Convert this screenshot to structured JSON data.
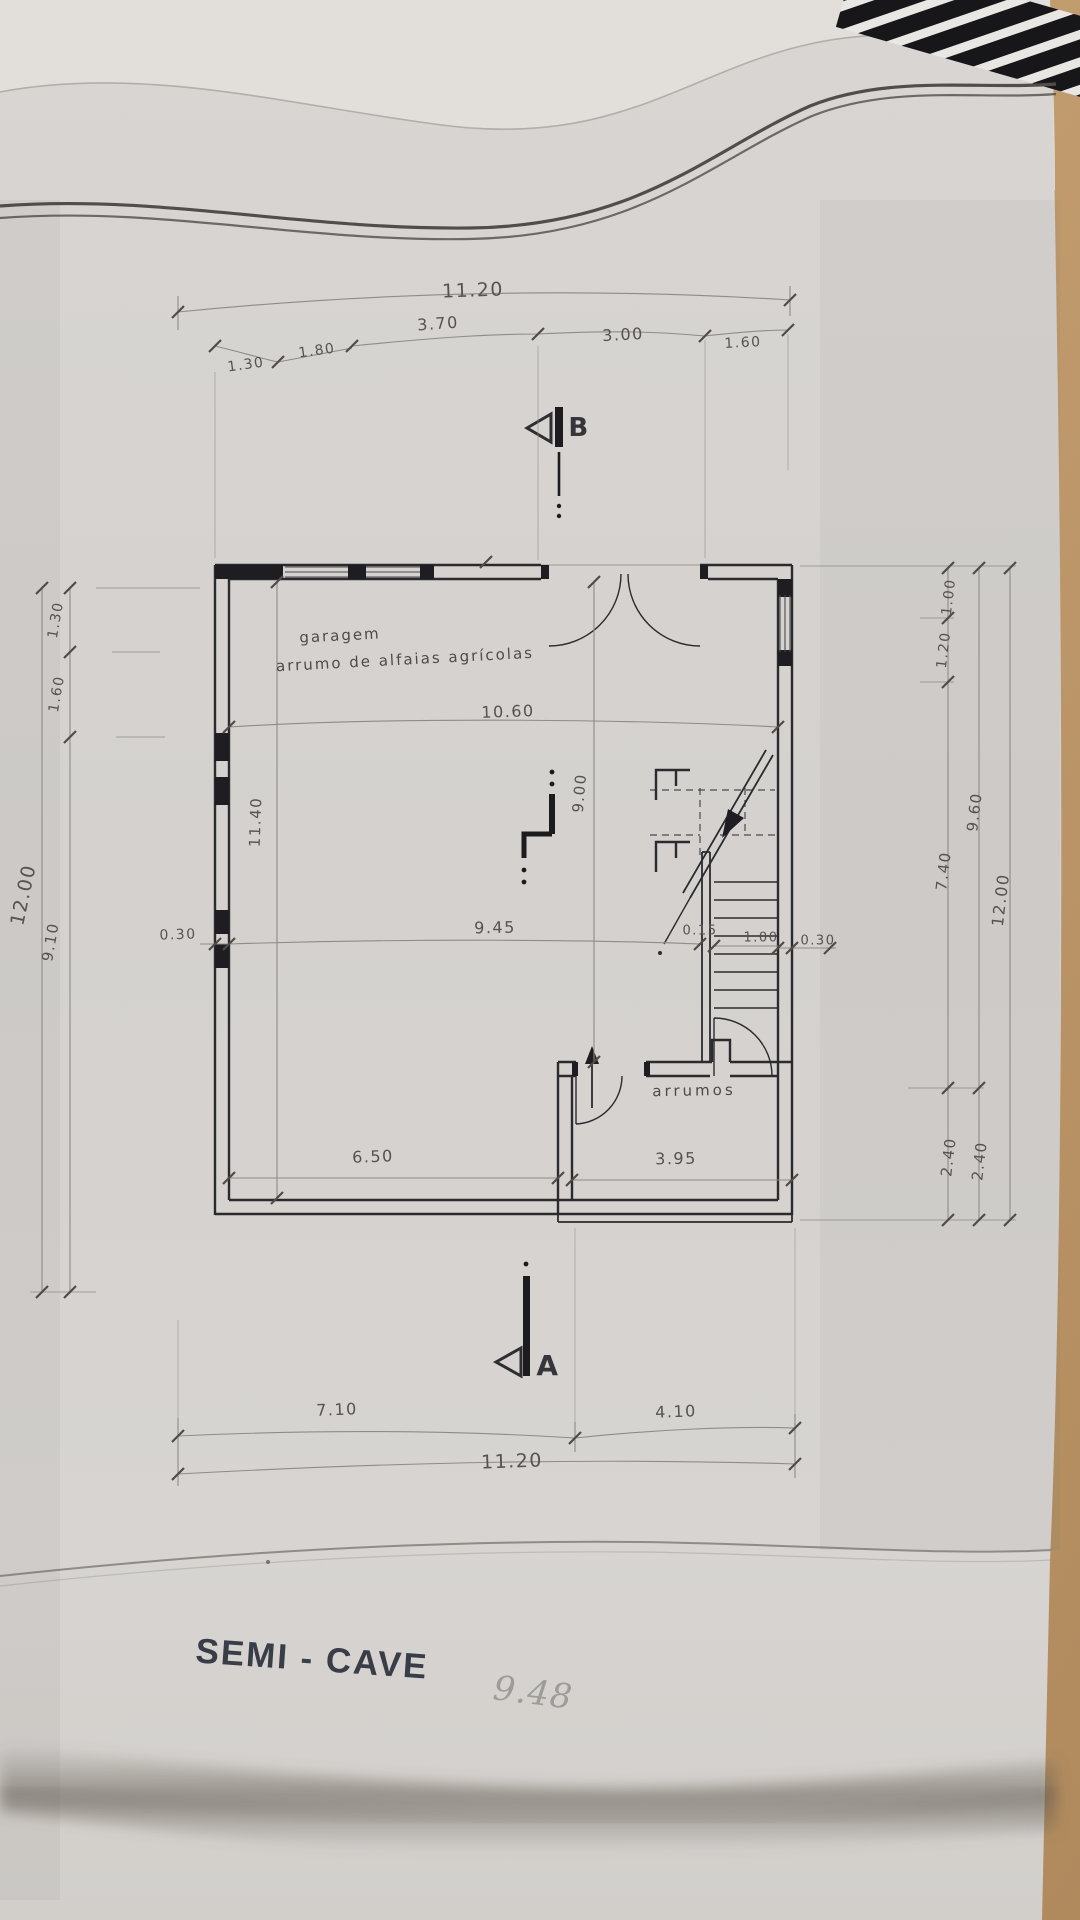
{
  "title_block": {
    "title": "SEMI - CAVE",
    "handwritten_note": "9.48"
  },
  "rooms": {
    "garage_line1": "garagem",
    "garage_line2": "arrumo de alfaias agrícolas",
    "storage": "arrumos"
  },
  "section_markers": {
    "a": "A",
    "b": "B"
  },
  "dimensions": {
    "top": {
      "total": "11.20",
      "seg_3_70": "3.70",
      "seg_3_00": "3.00",
      "seg_1_60": "1.60",
      "seg_1_30": "1.30",
      "seg_1_80": "1.80"
    },
    "left": {
      "total": "12.00",
      "seg_1_30": "1.30",
      "seg_1_60": "1.60",
      "seg_9_10": "9.10",
      "wall_0_30": "0.30",
      "inner_11_40": "11.40"
    },
    "right": {
      "seg_1_00": "1.00",
      "seg_1_20": "1.20",
      "seg_7_40": "7.40",
      "seg_9_60": "9.60",
      "total": "12.00",
      "seg_2_40_a": "2.40",
      "seg_2_40_b": "2.40"
    },
    "interior": {
      "w_10_60": "10.60",
      "h_9_00": "9.00",
      "w_9_45": "9.45",
      "w_0_15": "0.15",
      "w_1_00": "1.00",
      "w_0_30": "0.30",
      "w_6_50": "6.50",
      "w_3_95": "3.95"
    },
    "bottom": {
      "seg_7_10": "7.10",
      "seg_4_10": "4.10",
      "total": "11.20"
    }
  },
  "colors": {
    "paper": "#d6d3d0",
    "desk": "#c9a77c",
    "wall_ink": "#2b2b2e",
    "dim_ink": "#8f8c86",
    "text_ink": "#56534f",
    "title_ink": "#383d47",
    "pencil": "#9d9c99"
  }
}
